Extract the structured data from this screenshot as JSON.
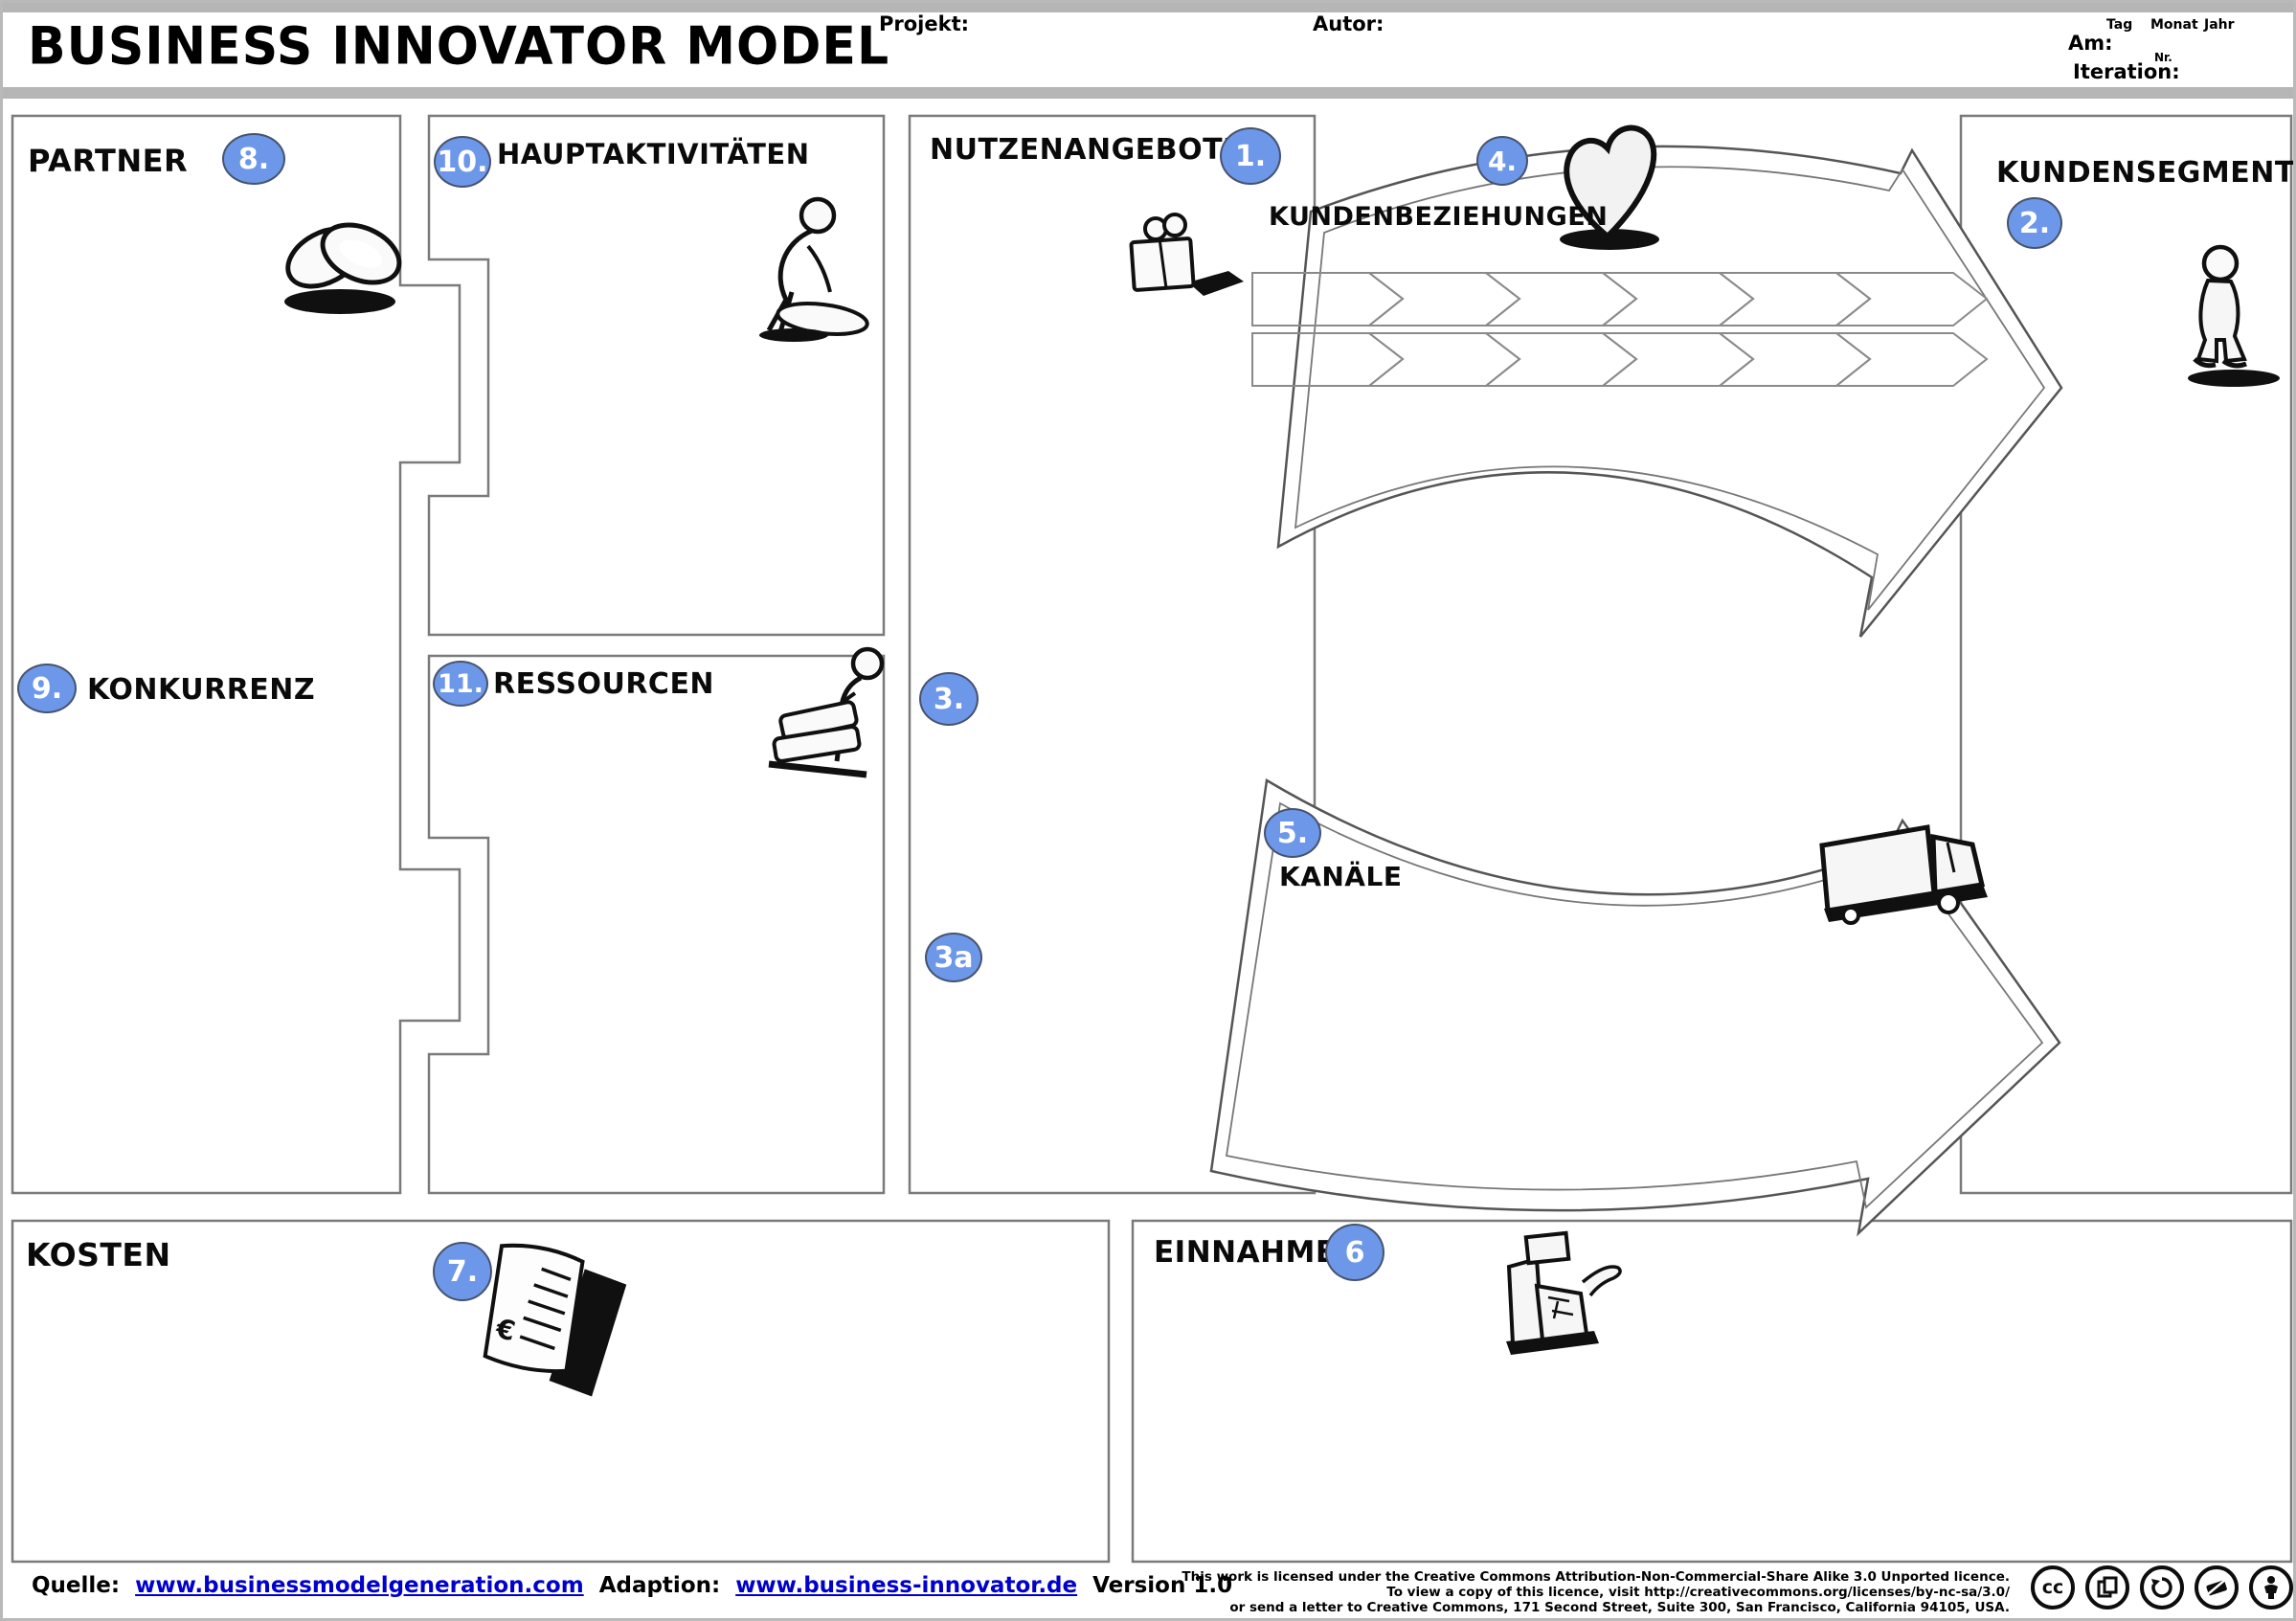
{
  "header": {
    "title": "BUSINESS INNOVATOR MODEL",
    "projekt_label": "Projekt:",
    "autor_label": "Autor:",
    "am_label": "Am:",
    "iteration_label": "Iteration:",
    "date_cols": {
      "tag": "Tag",
      "monat": "Monat",
      "jahr": "Jahr"
    },
    "nr_label": "Nr."
  },
  "colors": {
    "badge_blue": "#6d97e8",
    "link_blue": "#0000cc",
    "frame_gray": "#b6b6b6"
  },
  "sections": {
    "partner": {
      "label": "PARTNER",
      "badge": "8."
    },
    "konkurrenz": {
      "label": "KONKURRENZ",
      "badge": "9."
    },
    "hauptaktivitaeten": {
      "label": "HAUPTAKTIVITÄTEN",
      "badge": "10."
    },
    "ressourcen": {
      "label": "RESSOURCEN",
      "badge": "11."
    },
    "nutzenangebote": {
      "label": "NUTZENANGEBOTE",
      "badge": "1.",
      "badge_3": "3.",
      "badge_3a": "3a"
    },
    "kundenbeziehungen": {
      "label": "KUNDENBEZIEHUNGEN",
      "badge": "4."
    },
    "kundensegmente": {
      "label": "KUNDENSEGMENTE",
      "badge": "2."
    },
    "kanaele": {
      "label": "KANÄLE",
      "badge": "5."
    },
    "kosten": {
      "label": "KOSTEN",
      "badge": "7."
    },
    "einnahmen": {
      "label": "EINNAHMEN",
      "badge": "6"
    }
  },
  "icons": {
    "partner": "interlocked-rings-icon",
    "hauptaktivitaeten": "worker-person-icon",
    "ressourcen": "person-machine-icon",
    "nutzenangebote": "gift-box-icon",
    "kundenbeziehungen": "heart-icon",
    "kundensegmente": "standing-person-icon",
    "kanaele": "delivery-truck-icon",
    "kosten": "invoice-document-icon",
    "einnahmen": "cash-register-icon",
    "license": [
      "cc-icon",
      "copy-icon",
      "share-alike-icon",
      "non-commercial-icon",
      "attribution-icon"
    ]
  },
  "footer": {
    "quelle_label": "Quelle:",
    "quelle_link": "www.businessmodelgeneration.com",
    "adaption_label": "Adaption:",
    "adaption_link": "www.business-innovator.de",
    "version": "Version 1.0",
    "license_lines": [
      "This work is licensed under the Creative Commons Attribution-Non-Commercial-Share Alike 3.0 Unported licence.",
      "To view a copy of this licence, visit http://creativecommons.org/licenses/by-nc-sa/3.0/",
      "or send a letter to Creative Commons, 171 Second Street, Suite 300, San Francisco, California 94105, USA."
    ]
  }
}
